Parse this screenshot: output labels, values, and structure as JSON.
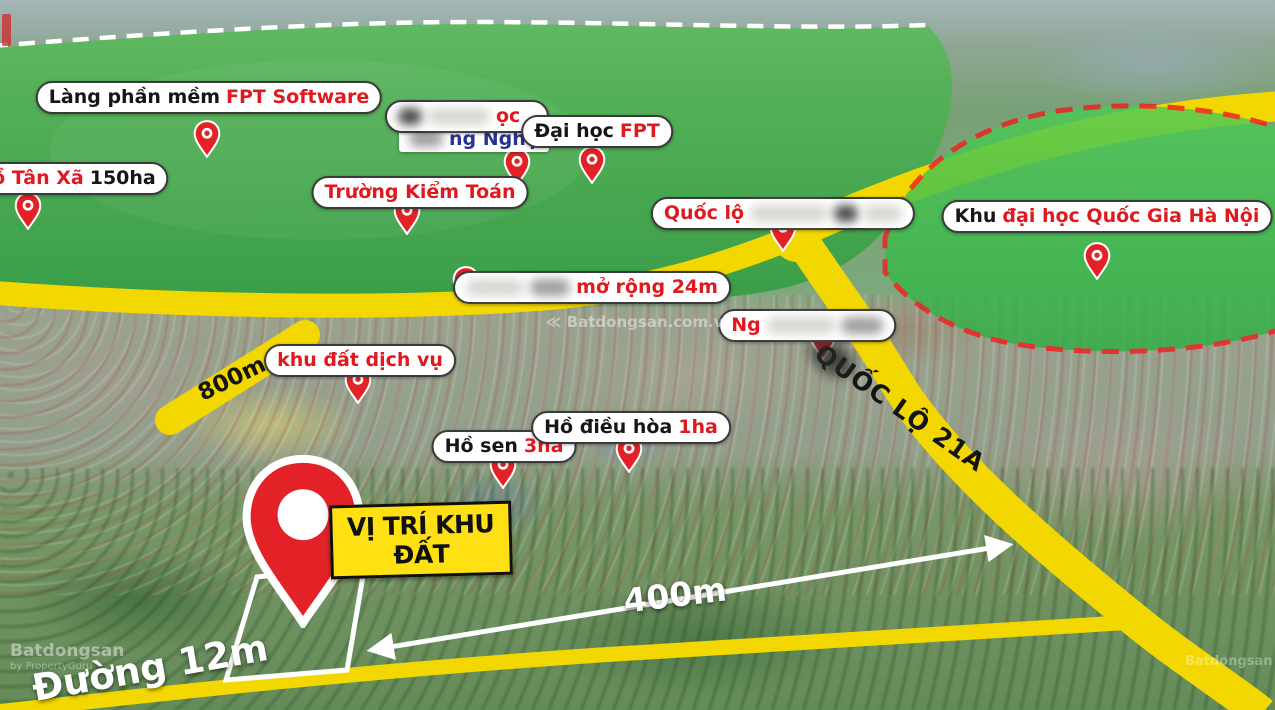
{
  "labels": {
    "lang_fpt": {
      "prefix": "Làng phần mềm",
      "highlight": "FPT Software"
    },
    "dai_hoc_redacted": {
      "fragment_top": "ọc",
      "fragment_bottom": "ng Nghệ"
    },
    "dai_hoc_fpt": {
      "prefix": "Đại học",
      "highlight": "FPT"
    },
    "ho_tan_xa": {
      "highlight": "Hồ Tân Xã",
      "suffix": "150ha"
    },
    "truong_kiem_toan": {
      "text": "Trường Kiểm Toán"
    },
    "quoc_lo_redacted": {
      "visible": "Quốc lộ"
    },
    "khu_dhqg": {
      "prefix": "Khu",
      "highlight": "đại học Quốc Gia Hà Nội"
    },
    "mo_rong": {
      "visible": "mở rộng 24m"
    },
    "ng_redacted": {
      "visible": "Ng"
    },
    "khu_dat_dich_vu": {
      "text": "khu đất dịch vụ"
    },
    "ho_sen": {
      "prefix": "Hồ sen",
      "highlight": "3ha"
    },
    "ho_dieu_hoa": {
      "prefix": "Hồ điều hòa",
      "highlight": "1ha"
    },
    "site_box": {
      "text": "VỊ TRÍ KHU ĐẤT"
    }
  },
  "road_labels": {
    "d800": "800m",
    "ql21a": "QUỐC LỘ 21A",
    "duong12": "Đường 12m",
    "d400": "400m"
  },
  "watermarks": {
    "brand_full": "Batdongsan.com.vn",
    "brand": "Batdongsan",
    "byline": "by PropertyGuru"
  },
  "colors": {
    "accent_red": "#e0191f",
    "pin_red": "#e32227",
    "road_yellow": "#f2d800",
    "green_zone": "#45b14b",
    "university_zone_green": "#3dbf4f",
    "university_zone_border": "#ef1f1f",
    "site_box_yellow": "#ffe013",
    "navy": "#27338f"
  }
}
